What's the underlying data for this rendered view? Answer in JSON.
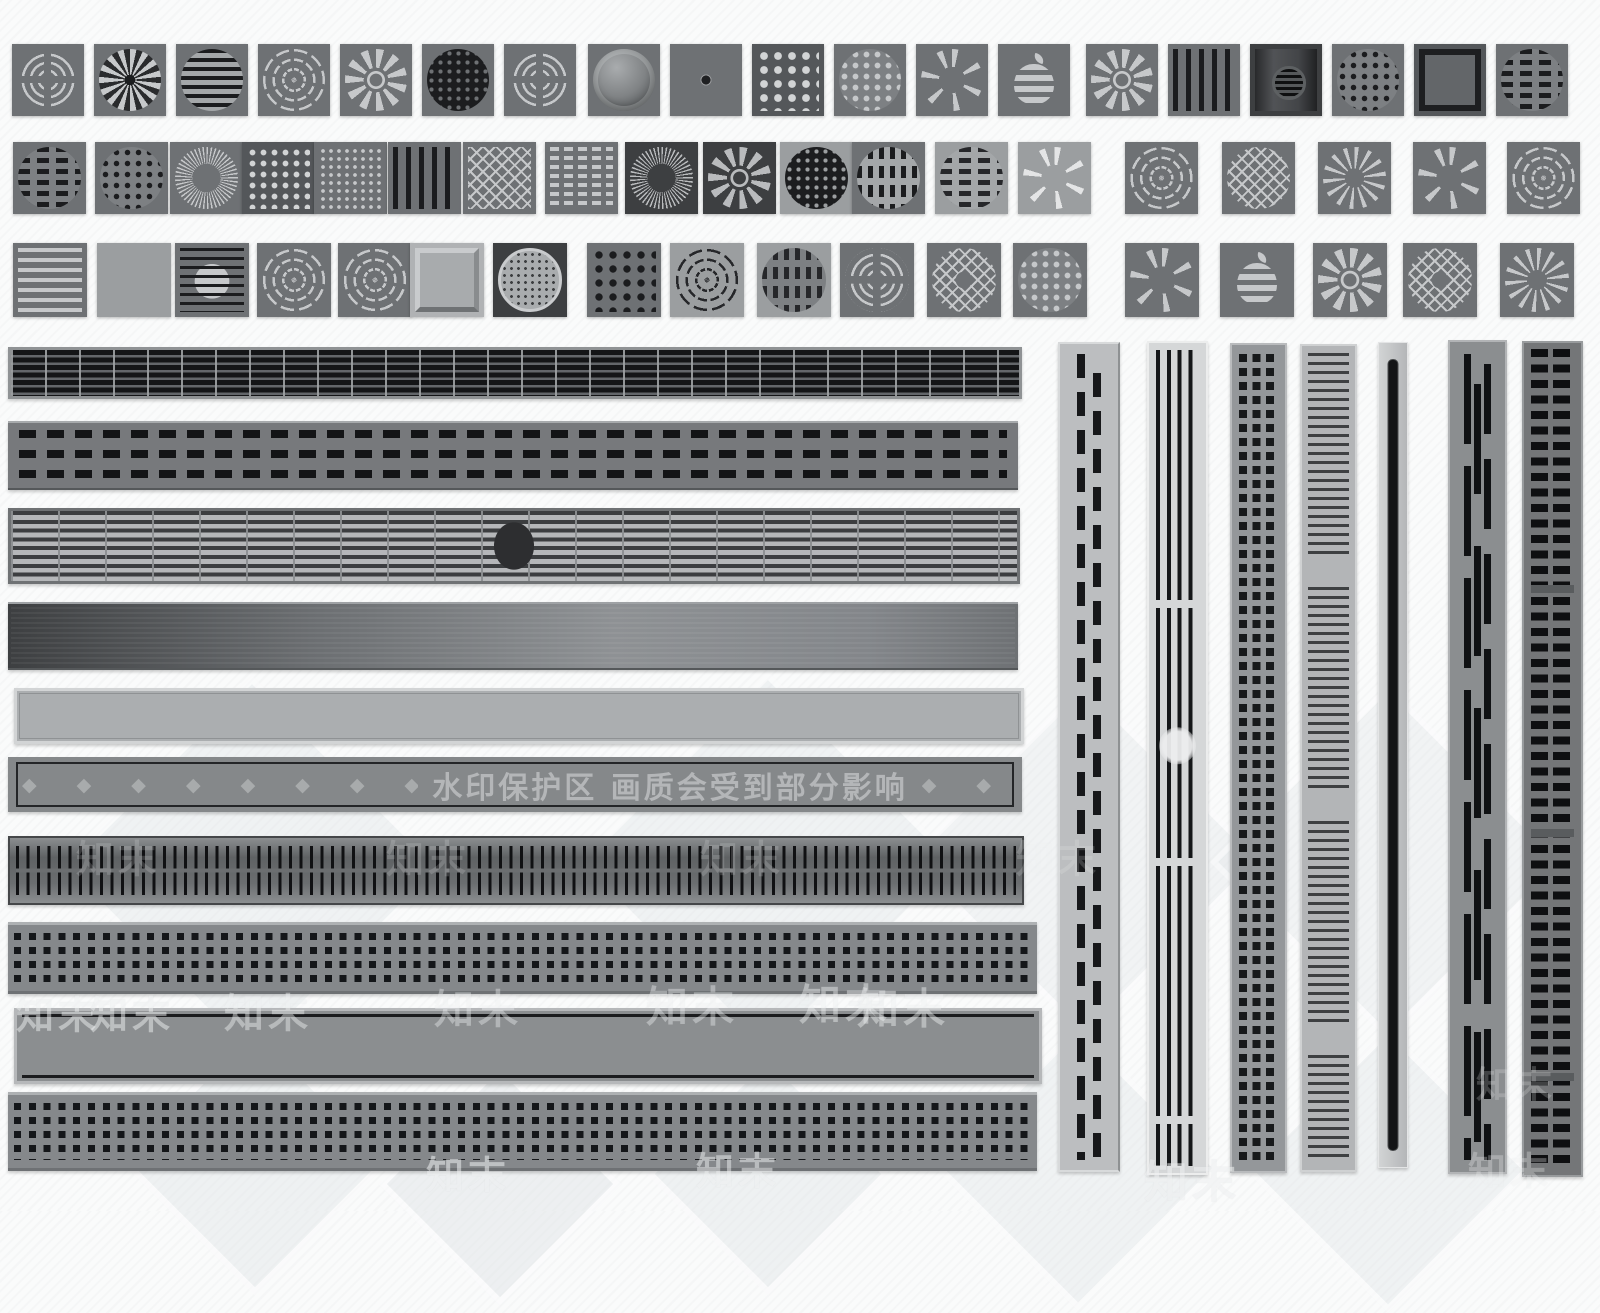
{
  "watermark": {
    "protect_text": "水印保护区  画质会受到部分影响",
    "brand": "知末",
    "s6_diamonds_left": "◆ ◆ ◆ ◆ ◆ ◆ ◆ ◆ ◆ ◆ ◆ ◆ ◆ ◆ ◆",
    "s6_diamonds_right": "◆ ◆",
    "brand_marks": [
      {
        "x": 58,
        "y": 1012,
        "s": 38,
        "o": 0.5
      },
      {
        "x": 132,
        "y": 1012,
        "s": 38,
        "o": 0.5
      },
      {
        "x": 268,
        "y": 1010,
        "s": 40,
        "o": 0.45
      },
      {
        "x": 478,
        "y": 1006,
        "s": 40,
        "o": 0.4
      },
      {
        "x": 692,
        "y": 1004,
        "s": 42,
        "o": 0.4
      },
      {
        "x": 845,
        "y": 1002,
        "s": 42,
        "o": 0.45
      },
      {
        "x": 903,
        "y": 1006,
        "s": 42,
        "o": 0.45
      },
      {
        "x": 118,
        "y": 856,
        "s": 38,
        "o": 0.18
      },
      {
        "x": 428,
        "y": 856,
        "s": 38,
        "o": 0.18
      },
      {
        "x": 742,
        "y": 856,
        "s": 38,
        "o": 0.18
      },
      {
        "x": 1058,
        "y": 856,
        "s": 38,
        "o": 0.18
      },
      {
        "x": 468,
        "y": 1172,
        "s": 38,
        "o": 0.55
      },
      {
        "x": 738,
        "y": 1168,
        "s": 38,
        "o": 0.5
      },
      {
        "x": 1192,
        "y": 1178,
        "s": 44,
        "o": 0.55
      },
      {
        "x": 1510,
        "y": 1168,
        "s": 38,
        "o": 0.3
      },
      {
        "x": 1516,
        "y": 1082,
        "s": 36,
        "o": 0.22
      }
    ]
  },
  "decor": {
    "diamonds": [
      {
        "x": 252,
        "y": 868,
        "s": 260,
        "o": 0.5
      },
      {
        "x": 768,
        "y": 864,
        "s": 260,
        "o": 0.5
      },
      {
        "x": 1085,
        "y": 860,
        "s": 240,
        "o": 0.45
      },
      {
        "x": 1388,
        "y": 862,
        "s": 240,
        "o": 0.45
      },
      {
        "x": 255,
        "y": 1160,
        "s": 180,
        "o": 0.55
      },
      {
        "x": 500,
        "y": 1184,
        "s": 160,
        "o": 0.6
      },
      {
        "x": 768,
        "y": 1174,
        "s": 160,
        "o": 0.55
      },
      {
        "x": 1078,
        "y": 1168,
        "s": 190,
        "o": 0.5
      },
      {
        "x": 1388,
        "y": 1170,
        "s": 190,
        "o": 0.5
      }
    ]
  },
  "colors": {
    "page_bg": "#fafbfb",
    "tile_mid": "#6e7174",
    "tile_dark": "#3d3f41",
    "tile_light": "#9b9ea0",
    "pattern_dark": "#1b1c1e",
    "pattern_light": "#c6c8ca",
    "steel_frame": "#b6b8ba"
  },
  "tiles": {
    "rows": [
      {
        "y": 44,
        "w": 72,
        "h": 72,
        "items": [
          {
            "x": 12,
            "pattern": "rings-cross",
            "tone": "mid"
          },
          {
            "x": 94,
            "pattern": "spiral-fan",
            "tone": "mid"
          },
          {
            "x": 176,
            "pattern": "wavy-slots",
            "tone": "mid"
          },
          {
            "x": 258,
            "pattern": "ring-arcs",
            "tone": "mid"
          },
          {
            "x": 340,
            "pattern": "petal-rosette",
            "tone": "mid"
          },
          {
            "x": 422,
            "pattern": "hex-mesh",
            "tone": "mid"
          },
          {
            "x": 504,
            "pattern": "rings-cross",
            "tone": "mid"
          },
          {
            "x": 588,
            "pattern": "dome",
            "tone": "mid"
          },
          {
            "x": 670,
            "pattern": "hole-plate",
            "tone": "mid"
          },
          {
            "x": 752,
            "pattern": "floral-lattice",
            "tone": "dark"
          },
          {
            "x": 834,
            "pattern": "scatter-dots",
            "tone": "mid"
          },
          {
            "x": 916,
            "pattern": "wedge-fan",
            "tone": "mid"
          },
          {
            "x": 998,
            "pattern": "apple",
            "tone": "mid"
          },
          {
            "x": 1086,
            "pattern": "petal-rosette",
            "tone": "mid"
          },
          {
            "x": 1168,
            "pattern": "vbars",
            "tone": "mid"
          },
          {
            "x": 1250,
            "pattern": "center-grate",
            "tone": "darker"
          },
          {
            "x": 1332,
            "pattern": "dot-columns",
            "tone": "mid"
          },
          {
            "x": 1414,
            "pattern": "plain-frame",
            "tone": "dark"
          },
          {
            "x": 1496,
            "pattern": "pill-dashes",
            "tone": "mid"
          }
        ]
      },
      {
        "y": 142,
        "w": 73,
        "h": 72,
        "items": [
          {
            "x": 13,
            "pattern": "dash-disc",
            "tone": "mid"
          },
          {
            "x": 95,
            "pattern": "tri-mesh",
            "tone": "mid"
          },
          {
            "x": 170,
            "pattern": "fine-spokes",
            "tone": "mid"
          },
          {
            "x": 242,
            "pattern": "pebble-grid",
            "tone": "dark"
          },
          {
            "x": 314,
            "pattern": "star-lattice",
            "tone": "mid"
          },
          {
            "x": 388,
            "pattern": "vbars",
            "tone": "mid"
          },
          {
            "x": 463,
            "pattern": "diamond-sq",
            "tone": "mid"
          },
          {
            "x": 545,
            "pattern": "brick-slots",
            "tone": "mid"
          },
          {
            "x": 625,
            "pattern": "fine-spokes",
            "tone": "darker"
          },
          {
            "x": 703,
            "pattern": "petal-rosette",
            "tone": "darker"
          },
          {
            "x": 780,
            "pattern": "hex-mesh",
            "tone": "light"
          },
          {
            "x": 852,
            "pattern": "vdash-disc-lt",
            "tone": "mid"
          },
          {
            "x": 935,
            "pattern": "dash-disc-lt",
            "tone": "light"
          },
          {
            "x": 1018,
            "pattern": "wedge-fan",
            "tone": "light"
          },
          {
            "x": 1125,
            "pattern": "ring-arcs",
            "tone": "mid"
          },
          {
            "x": 1222,
            "pattern": "diamond-disc",
            "tone": "mid"
          },
          {
            "x": 1318,
            "pattern": "turbine",
            "tone": "mid"
          },
          {
            "x": 1413,
            "pattern": "wedge-fan",
            "tone": "mid"
          },
          {
            "x": 1507,
            "pattern": "ring-arcs",
            "tone": "mid"
          }
        ]
      },
      {
        "y": 243,
        "w": 74,
        "h": 74,
        "items": [
          {
            "x": 13,
            "pattern": "hslats-sq",
            "tone": "mid"
          },
          {
            "x": 97,
            "pattern": "plain",
            "tone": "light"
          },
          {
            "x": 175,
            "pattern": "slats-disc",
            "tone": "mid"
          },
          {
            "x": 257,
            "pattern": "ring-arcs",
            "tone": "mid"
          },
          {
            "x": 338,
            "pattern": "ring-arcs",
            "tone": "mid"
          },
          {
            "x": 410,
            "pattern": "bevel",
            "tone": "lighter"
          },
          {
            "x": 493,
            "pattern": "ornate",
            "tone": "darker"
          },
          {
            "x": 587,
            "pattern": "quatrefoil",
            "tone": "mid"
          },
          {
            "x": 670,
            "pattern": "ring-arcs-dk",
            "tone": "light"
          },
          {
            "x": 757,
            "pattern": "vdash-disc-mid",
            "tone": "light"
          },
          {
            "x": 840,
            "pattern": "rings-cross",
            "tone": "mid"
          },
          {
            "x": 927,
            "pattern": "diamond-donut",
            "tone": "mid"
          },
          {
            "x": 1013,
            "pattern": "scatter-dots",
            "tone": "mid"
          },
          {
            "x": 1125,
            "pattern": "wedge-fan",
            "tone": "mid"
          },
          {
            "x": 1220,
            "pattern": "apple",
            "tone": "mid"
          },
          {
            "x": 1313,
            "pattern": "petal-rosette",
            "tone": "mid"
          },
          {
            "x": 1403,
            "pattern": "diamond-donut",
            "tone": "mid"
          },
          {
            "x": 1500,
            "pattern": "turbine",
            "tone": "mid"
          }
        ]
      }
    ]
  },
  "strips": {
    "horizontal": [
      {
        "id": "h1",
        "kind": "grid-grate",
        "x": 8,
        "y": 347,
        "w": 1014,
        "h": 52
      },
      {
        "id": "h2",
        "kind": "dash-rows",
        "x": 8,
        "y": 421,
        "w": 1010,
        "h": 65
      },
      {
        "id": "h3",
        "kind": "slat-grid-circle",
        "x": 8,
        "y": 508,
        "w": 1012,
        "h": 76
      },
      {
        "id": "h4",
        "kind": "brushed",
        "x": 8,
        "y": 602,
        "w": 1010,
        "h": 64
      },
      {
        "id": "h5",
        "kind": "plain-light",
        "x": 14,
        "y": 688,
        "w": 1004,
        "h": 50
      },
      {
        "id": "h6",
        "kind": "diamond-band",
        "x": 8,
        "y": 757,
        "w": 1014,
        "h": 55
      },
      {
        "id": "h7",
        "kind": "meander",
        "x": 8,
        "y": 836,
        "w": 1012,
        "h": 65
      },
      {
        "id": "h8",
        "kind": "perf-squares",
        "x": 8,
        "y": 922,
        "w": 1029,
        "h": 66
      },
      {
        "id": "h9",
        "kind": "plain-frame-dark",
        "x": 14,
        "y": 1008,
        "w": 1022,
        "h": 70
      },
      {
        "id": "h10",
        "kind": "perf-squares",
        "x": 8,
        "y": 1092,
        "w": 1029,
        "h": 73
      }
    ],
    "vertical": [
      {
        "id": "v1",
        "kind": "pill-cols",
        "x": 1058,
        "y": 342,
        "w": 58,
        "h": 826
      },
      {
        "id": "v2",
        "kind": "vslots-circle",
        "x": 1147,
        "y": 341,
        "w": 57,
        "h": 830
      },
      {
        "id": "v3",
        "kind": "square-grid",
        "x": 1230,
        "y": 343,
        "w": 53,
        "h": 826
      },
      {
        "id": "v4",
        "kind": "slat-sections",
        "x": 1300,
        "y": 344,
        "w": 53,
        "h": 824
      },
      {
        "id": "v5",
        "kind": "single-slot",
        "x": 1378,
        "y": 342,
        "w": 28,
        "h": 824
      },
      {
        "id": "v6",
        "kind": "slot-cols",
        "x": 1448,
        "y": 340,
        "w": 55,
        "h": 830
      },
      {
        "id": "v7",
        "kind": "bar-ladder",
        "x": 1522,
        "y": 341,
        "w": 57,
        "h": 832
      }
    ]
  }
}
